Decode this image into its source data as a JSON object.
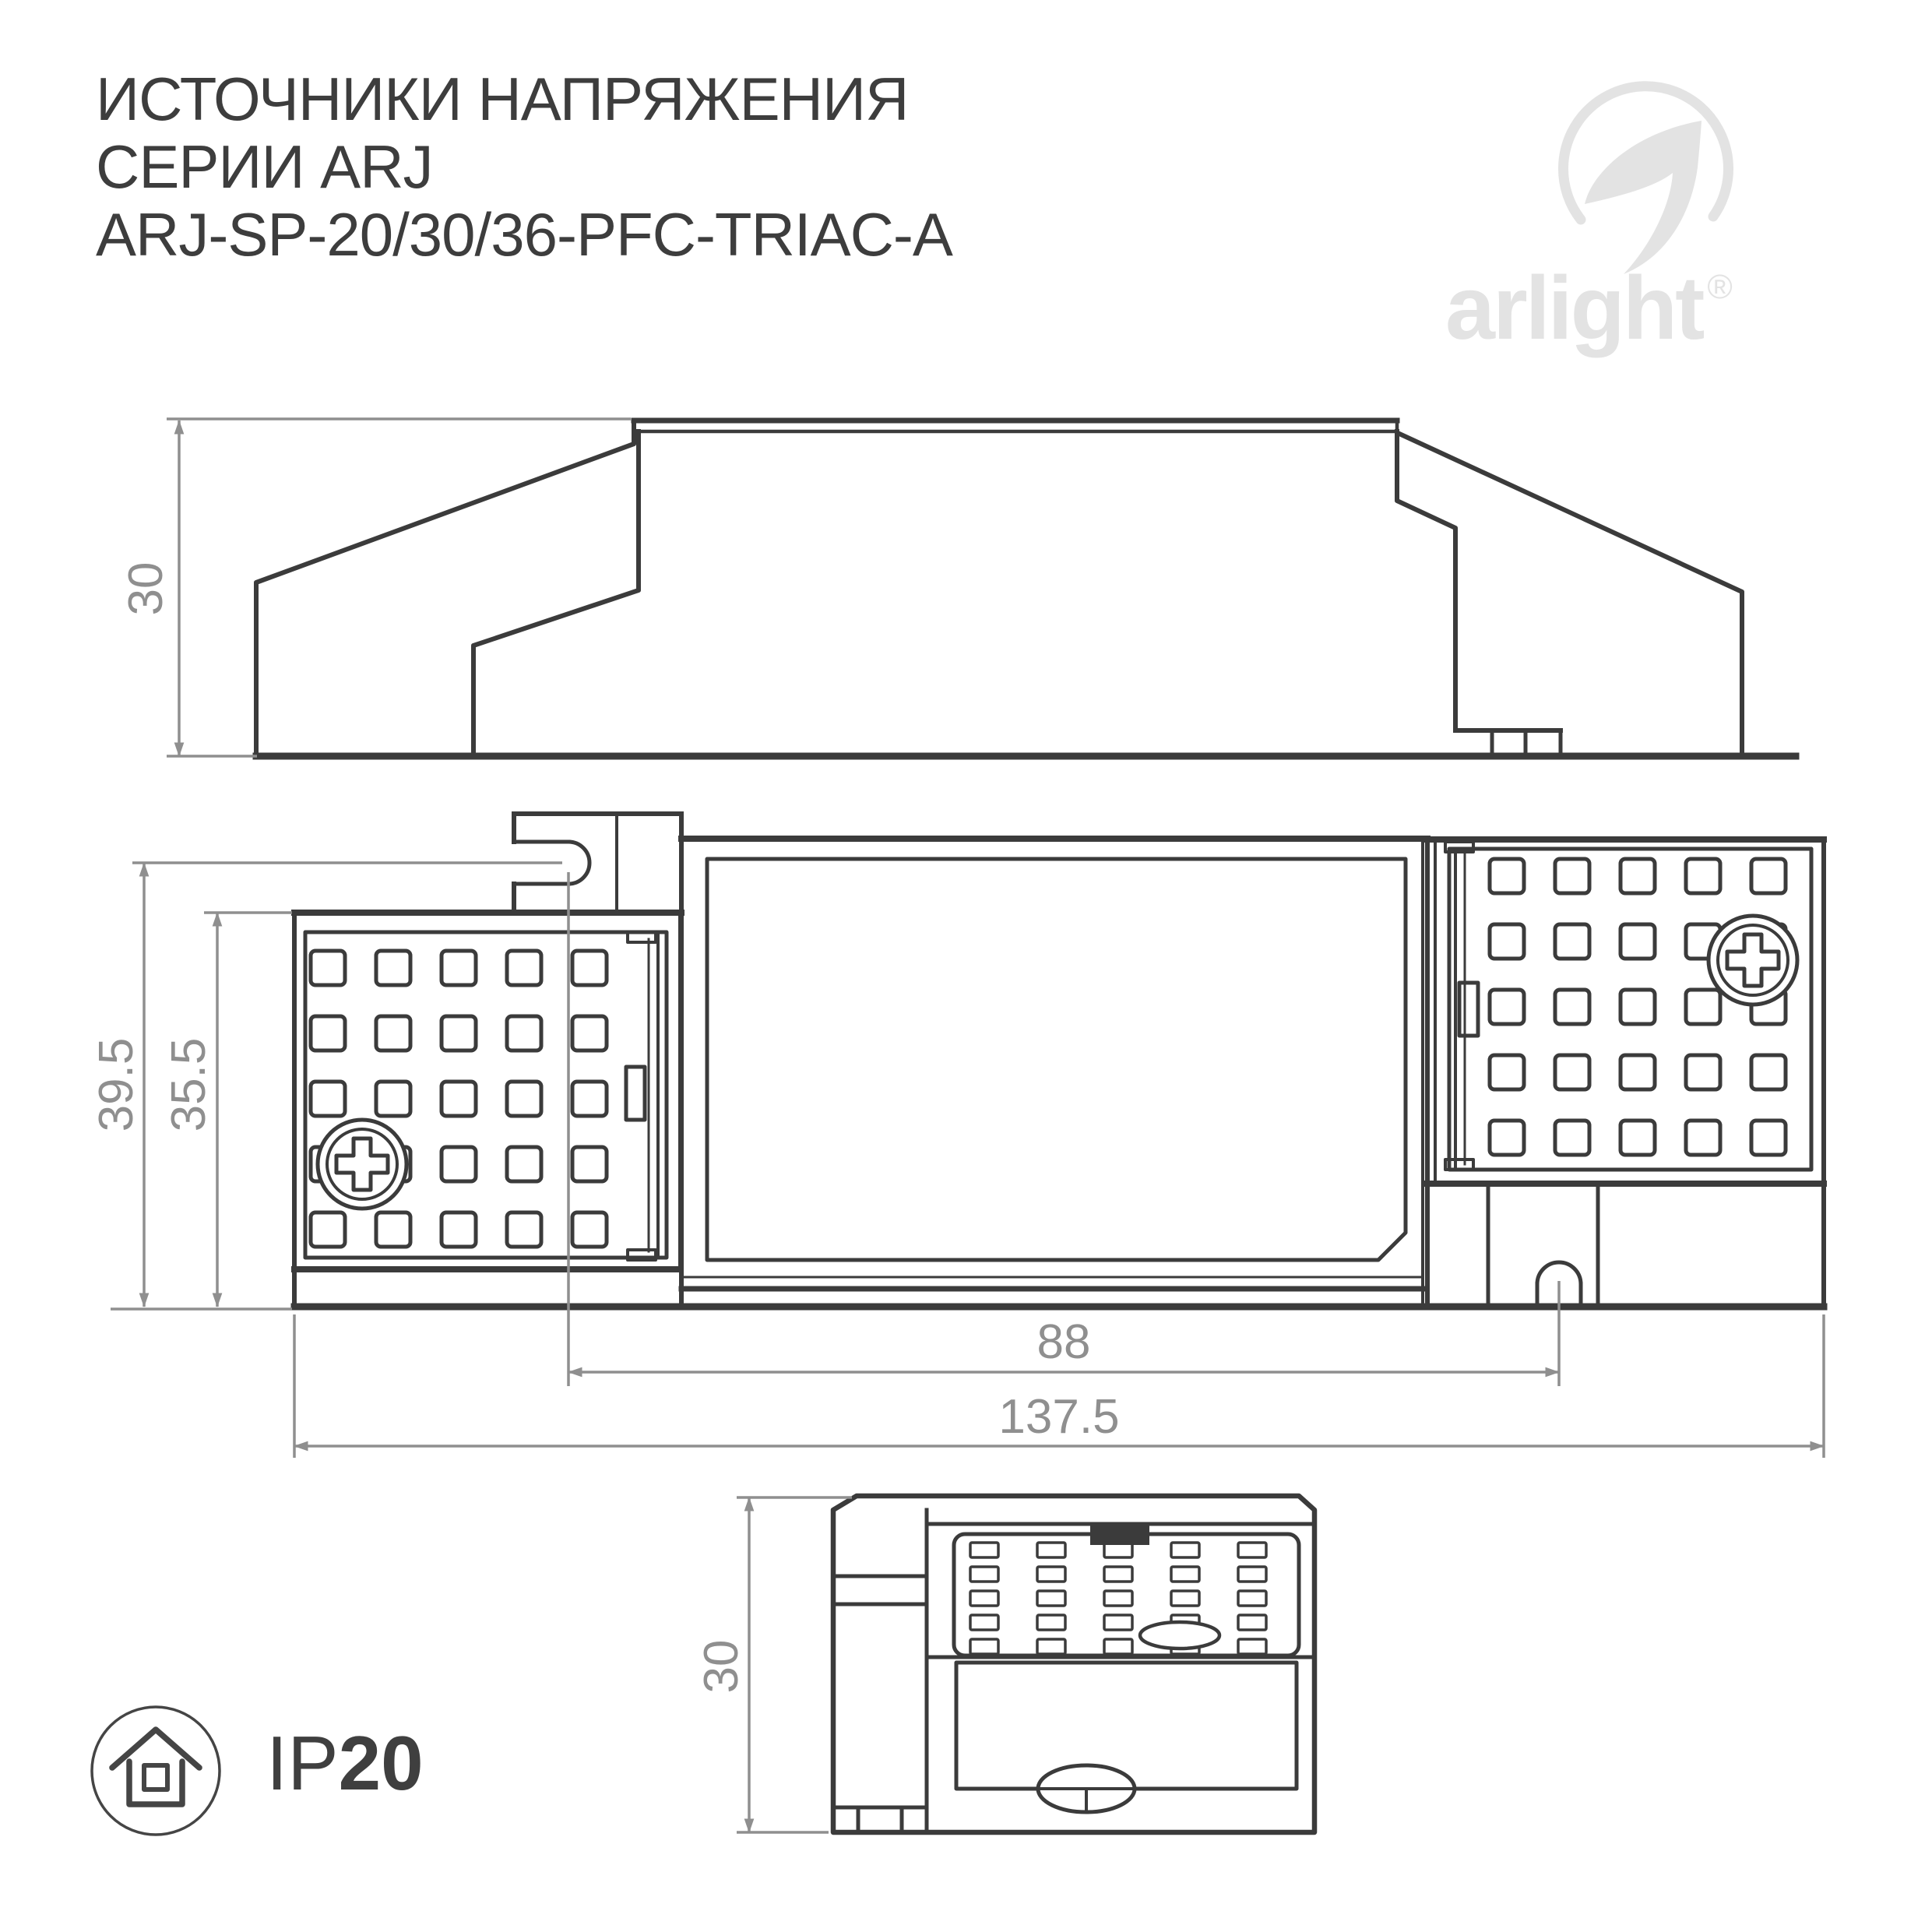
{
  "title": {
    "line1": "ИСТОЧНИКИ НАПРЯЖЕНИЯ",
    "line2": "СЕРИИ ARJ",
    "line3": "ARJ-SP-20/30/36-PFC-TRIAC-A"
  },
  "logo": {
    "brand": "arlight",
    "registered": "®"
  },
  "views": {
    "side": {
      "height_mm": "30"
    },
    "plan": {
      "overall_length_mm": "137.5",
      "mounting_distance_mm": "88",
      "overall_depth_mm": "39.5",
      "body_depth_mm": "35.5"
    },
    "front": {
      "height_mm": "30"
    }
  },
  "badge": {
    "prefix": "IP",
    "rating": "20"
  },
  "colors": {
    "drawing_line": "#3b3b3b",
    "dimension_line": "#8f8f8f",
    "logo_gray": "#e3e3e3",
    "title_text": "#3d3d3d"
  }
}
